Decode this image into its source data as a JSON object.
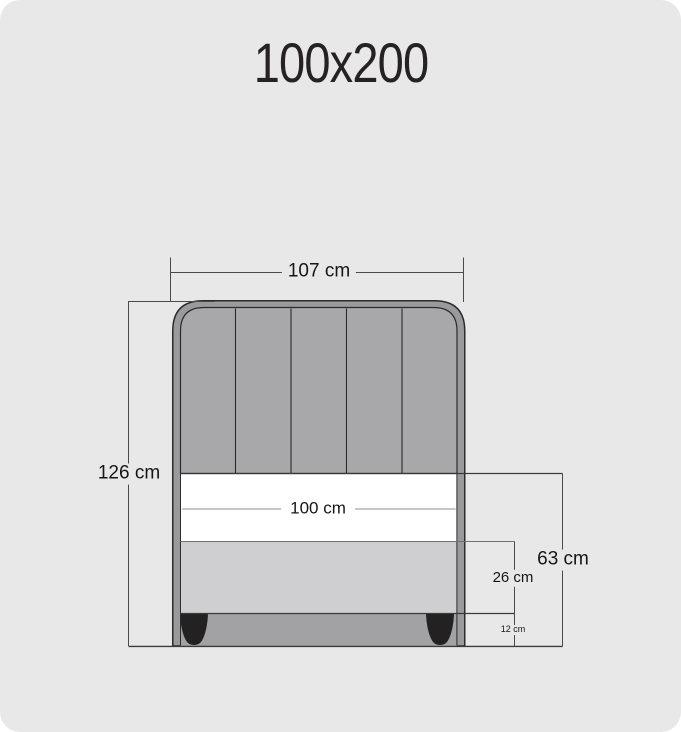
{
  "title": "100x200",
  "diagram": {
    "type": "bed-front-view-dimension-drawing",
    "headboard_panels": 5,
    "dimensions": {
      "outer_width": "107 cm",
      "total_height": "126 cm",
      "mattress_width": "100 cm",
      "side_height": "63 cm",
      "base_height": "26 cm",
      "leg_height": "12 cm"
    },
    "colors": {
      "background": "#e8e8e8",
      "outline": "#2b2b2b",
      "frame_gray": "#9a9a9d",
      "headboard_gray": "#a8a8aa",
      "mattress_white": "#ffffff",
      "base_gray": "#cfcfd1",
      "recess_gray": "#a2a2a4",
      "foot_black": "#242122",
      "dimension_line": "#4a4a4a"
    }
  }
}
